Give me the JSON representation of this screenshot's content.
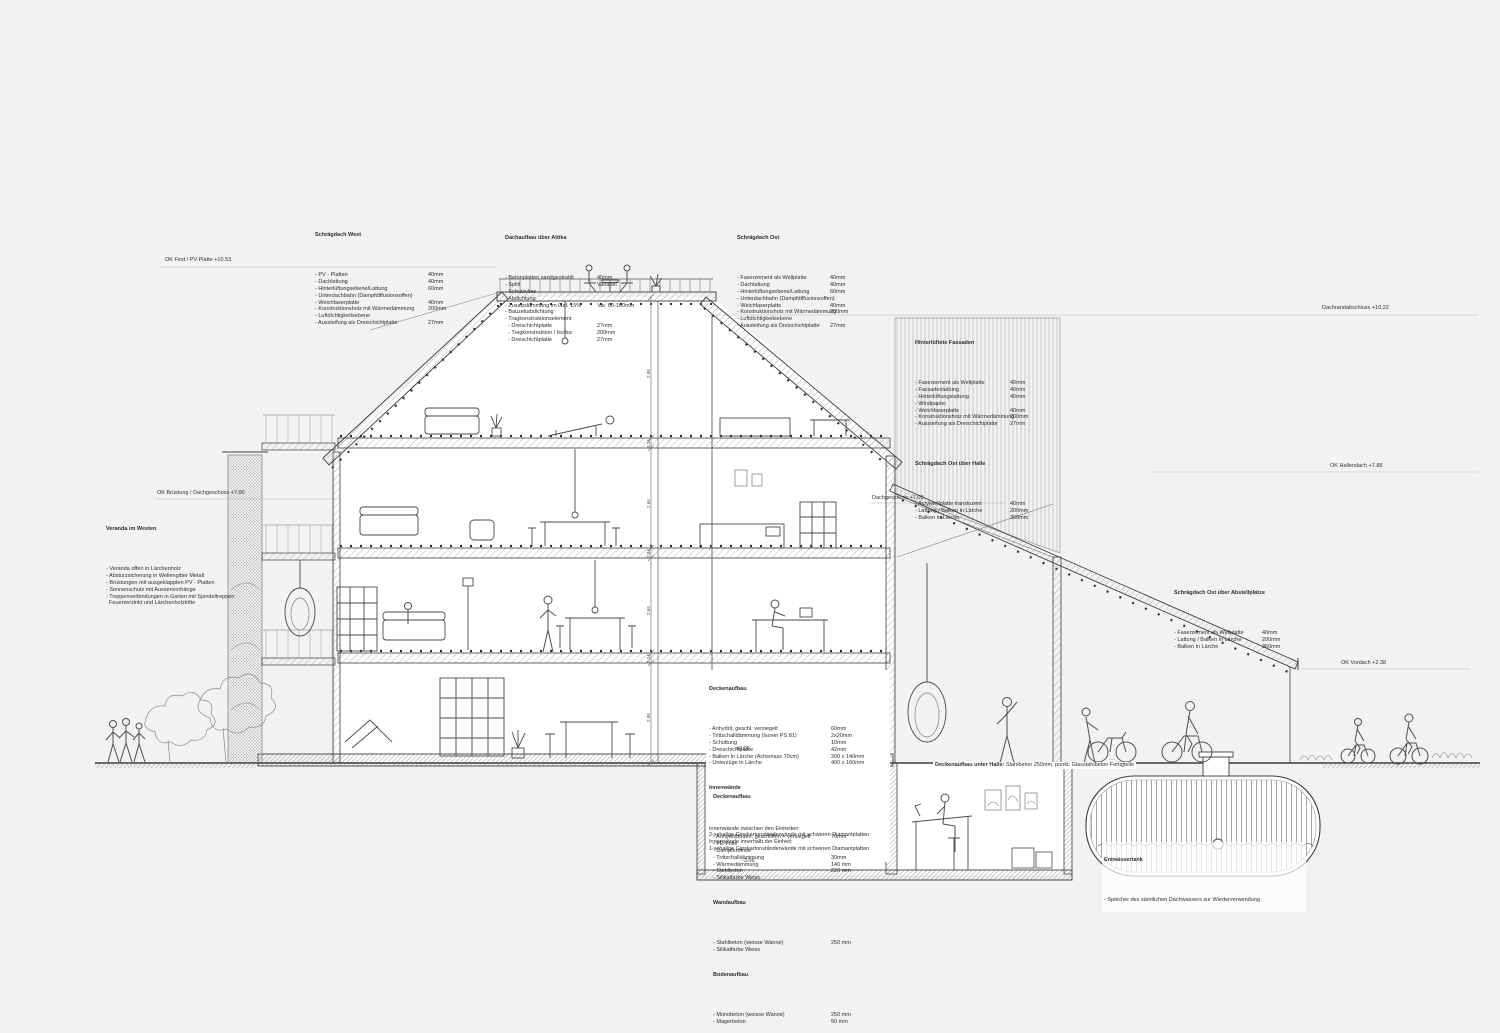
{
  "colors": {
    "background": "#f2f2f0",
    "paper": "#ffffff",
    "line_dark": "#3d3d3d",
    "line_light": "#9a9a9a",
    "hatch": "#a8a8a8"
  },
  "specs": {
    "schraegdach_west": {
      "title": "Schrägdach West",
      "rows": [
        {
          "l": "- PV - Platten",
          "v": "40mm"
        },
        {
          "l": "- Dachlattung",
          "v": "40mm"
        },
        {
          "l": "- Hinterlüftungsebene/Lattung",
          "v": "60mm"
        },
        {
          "l": "- Unterdachbahn (Dampfdiffusionsoffen)",
          "v": ""
        },
        {
          "l": "- Weichfaserplatte",
          "v": "40mm"
        },
        {
          "l": "- Konstruktionsholz mit Wärmedämmung",
          "v": "200mm"
        },
        {
          "l": "- Luftdichtigkeitsebene",
          "v": ""
        },
        {
          "l": "- Aussteifung als Dreischichtplatte",
          "v": "27mm"
        }
      ]
    },
    "dachaufbau_attika": {
      "title": "Dachaufbau über Attika",
      "rows": [
        {
          "l": "- Betonplatten sandgestrahlt",
          "v": "40mm"
        },
        {
          "l": "- Splitt",
          "v": "Variabel"
        },
        {
          "l": "- Schutzvlies",
          "v": ""
        },
        {
          "l": "- Abdichtung",
          "v": ""
        },
        {
          "l": "- Zusatzdämmung im Gef. 15%",
          "v": "Var. 60-160mm"
        },
        {
          "l": "- Bauzeitabdichtung",
          "v": ""
        },
        {
          "l": "- Tragkonstruktionselement",
          "v": ""
        },
        {
          "l": "  - Dreischichtplatte",
          "v": "27mm"
        },
        {
          "l": "  - Tragkonstruktion / Isofloc",
          "v": "200mm"
        },
        {
          "l": "  - Dreischichtplatte",
          "v": "27mm"
        }
      ]
    },
    "schraegdach_ost": {
      "title": "Schrägdach Ost",
      "rows": [
        {
          "l": "- Faserzement als Wellplatte",
          "v": "40mm"
        },
        {
          "l": "- Dachlattung",
          "v": "40mm"
        },
        {
          "l": "- Hinterlüftungsebene/Lattung",
          "v": "60mm"
        },
        {
          "l": "- Unterdachbahn (Dampfdiffusionsoffen)",
          "v": ""
        },
        {
          "l": "- Weichfaserplatte",
          "v": "40mm"
        },
        {
          "l": "- Konstruktionsholz mit Wärmedämmung",
          "v": "200mm"
        },
        {
          "l": "- Luftdichtigkeitsebene",
          "v": ""
        },
        {
          "l": "- Aussteifung als Dreischichtplatte",
          "v": "27mm"
        }
      ]
    },
    "hinterlueftete_fassaden": {
      "title": "Hinterlüftete Fassaden",
      "rows": [
        {
          "l": "- Faserzement als Wellplatte",
          "v": "40mm"
        },
        {
          "l": "- Fassadenlattung",
          "v": "40mm"
        },
        {
          "l": "- Hinterlüftungslattung",
          "v": "40mm"
        },
        {
          "l": "- Windpapier",
          "v": ""
        },
        {
          "l": "- Weichfaserplatte",
          "v": "40mm"
        },
        {
          "l": "- Konstruktionsholz mit Wärmedämmung",
          "v": "200mm"
        },
        {
          "l": "- Aussteifung als Dreischichtplatte",
          "v": "27mm"
        }
      ]
    },
    "schraegdach_ost_halle": {
      "title": "Schrägdach Ost über Halle",
      "rows": [
        {
          "l": "- Acrylwellplatte transluzent",
          "v": "40mm"
        },
        {
          "l": "- Lattung / Balken in Lärche",
          "v": "200mm"
        },
        {
          "l": "- Balken in Lärche",
          "v": "300mm"
        }
      ]
    },
    "schraegdach_ost_abstell": {
      "title": "Schrägdach Ost über Abstellplätze",
      "rows": [
        {
          "l": "- Faserzement als Wellplatte",
          "v": "40mm"
        },
        {
          "l": "- Lattung / Balken in Lärche",
          "v": "200mm"
        },
        {
          "l": "- Balken in Lärche",
          "v": "360mm"
        }
      ]
    },
    "veranda_westen": {
      "title": "Veranda im Westen",
      "rows": [
        {
          "l": "- Veranda offen in Lärchenholz",
          "v": ""
        },
        {
          "l": "- Absturzsicherung in Wellengitter Metall",
          "v": ""
        },
        {
          "l": "- Brüstungen mit ausgeklappten PV - Platten",
          "v": ""
        },
        {
          "l": "- Sonnenschutz mit Aussenvorhänge",
          "v": ""
        },
        {
          "l": "- Treppenverbindungen in Garten mit Spindeltreppen",
          "v": ""
        },
        {
          "l": "  Feuerverzinkt und Lärchenholztritte",
          "v": ""
        }
      ]
    },
    "deckenaufbau_og": {
      "title": "Deckenaufbau",
      "rows": [
        {
          "l": "- Anhydrit, geschl. versiegelt",
          "v": "60mm"
        },
        {
          "l": "- Trittschalldämmung (Isover PS 81)",
          "v": "2x20mm"
        },
        {
          "l": "- Schüttung",
          "v": "10mm"
        },
        {
          "l": "- Dreischichtplatte",
          "v": "42mm"
        },
        {
          "l": "- Balken in Lärche (Achsmass 70cm)",
          "v": "200 x 140mm"
        },
        {
          "l": "- Unterzüge in Lärche",
          "v": "400 x 160mm"
        }
      ],
      "subtitle": "Innenwände",
      "lines": [
        {
          "l": "Innenwände zwischen den Einheiten:",
          "v": ""
        },
        {
          "l": "2-schalige Gipskartonständerwände mit schweren Diamantplatten",
          "v": ""
        },
        {
          "l": "Innenwände innerhalb der Einheit:",
          "v": ""
        },
        {
          "l": "1-schalige Gipskartonständerwände mit schweren Diamantplatten",
          "v": ""
        }
      ]
    },
    "deckenaufbau_ug": {
      "title": "Deckenaufbau",
      "rows": [
        {
          "l": "- Anhydritboden, geschliffen + versiegelt",
          "v": "70mm"
        },
        {
          "l": "- PE-Folie",
          "v": ""
        },
        {
          "l": "- Dampfbremse",
          "v": ""
        },
        {
          "l": "- Trittschalldämmung",
          "v": "30mm"
        },
        {
          "l": "- Wärmedämmung",
          "v": "140 mm"
        },
        {
          "l": "- Stahlbeton",
          "v": "220 mm"
        },
        {
          "l": "- Silikatfarbe Weiss",
          "v": ""
        }
      ]
    },
    "wandaufbau": {
      "title": "Wandaufbau",
      "rows": [
        {
          "l": "- Stahlbeton (weisse Wanne)",
          "v": "250 mm"
        },
        {
          "l": "- Silikatfarbe Weiss",
          "v": ""
        }
      ]
    },
    "bodenaufbau": {
      "title": "Bodenaufbau",
      "rows": [
        {
          "l": "- Monobeton (weisse Wanne)",
          "v": "250 mm"
        },
        {
          "l": "- Magerbeton",
          "v": "50 mm"
        }
      ]
    },
    "entwaessertank": {
      "title": "Entwässertank",
      "rows": [
        {
          "l": "- Speicher des sämtlichen Dachwassers zur Wiederverwendung",
          "v": ""
        }
      ]
    }
  },
  "notes": {
    "halle_slab_bold": "Deckenaufbau unter Halle:",
    "halle_slab_rest": " Stahlbeton 250mm, punkt. Glasstahlbeton Fertigteile"
  },
  "elevations": {
    "ok_first": "OK First / PV-Platte +10.53",
    "dachrand": "Dachrandabschluss +10.22",
    "ok_hallendach": "OK Hallendach +7.88",
    "ok_vordach": "OK Vordach +2.38",
    "ok_bruestung": "OK Brüstung / Dachgeschoss +7.00",
    "dachgeschoss_ost": "Dachgeschoss +7.00",
    "level_zero": "±0.00",
    "level_minus": "-3.06"
  },
  "dims": [
    "2.86",
    "0.34",
    "2.66",
    "0.34",
    "2.66",
    "0.34",
    "2.86"
  ]
}
